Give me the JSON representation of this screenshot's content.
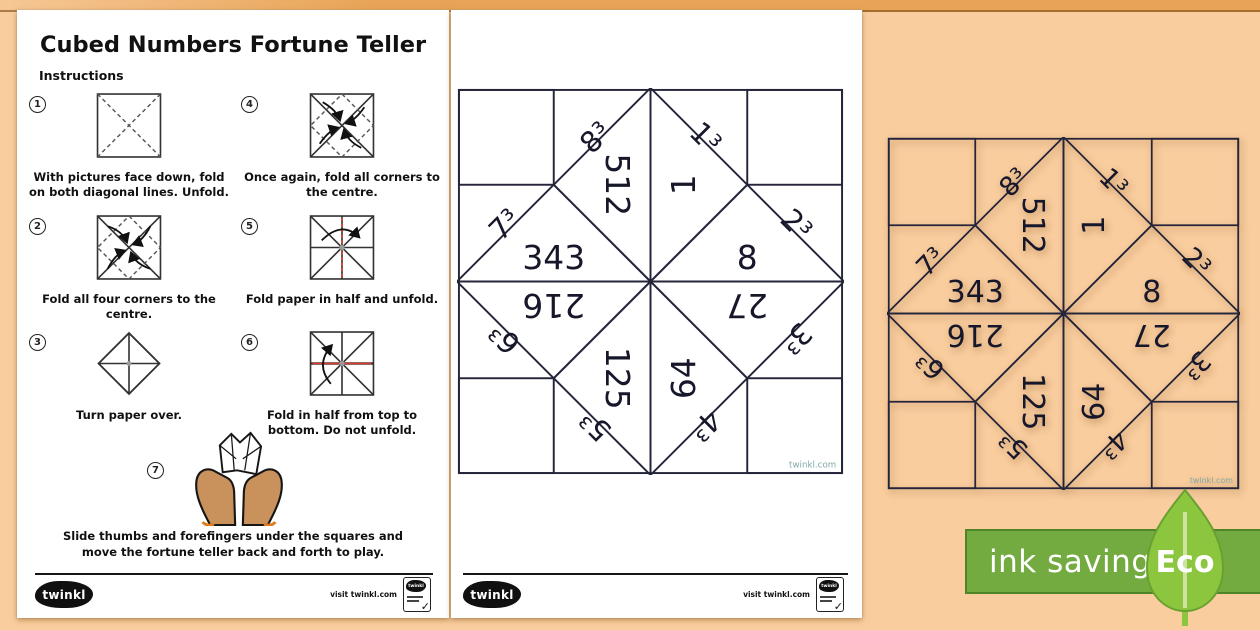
{
  "page1": {
    "title": "Cubed Numbers Fortune Teller",
    "subtitle": "Instructions",
    "steps": [
      {
        "num": "1",
        "text": "With pictures face down, fold on both diagonal lines. Unfold."
      },
      {
        "num": "2",
        "text": "Fold all four corners to the centre."
      },
      {
        "num": "3",
        "text": "Turn paper over."
      },
      {
        "num": "4",
        "text": "Once again, fold all corners to the centre."
      },
      {
        "num": "5",
        "text": "Fold paper in half and unfold."
      },
      {
        "num": "6",
        "text": "Fold in half from top to bottom. Do not unfold."
      },
      {
        "num": "7",
        "text": "Slide thumbs and forefingers under the squares and move the fortune teller back and forth to play."
      }
    ]
  },
  "teller": {
    "cubes": {
      "c1": "1³",
      "c2": "2³",
      "c3": "3³",
      "c4": "4³",
      "c5": "5³",
      "c6": "6³",
      "c7": "7³",
      "c8": "8³"
    },
    "values": {
      "v1": "1",
      "v8": "8",
      "v27": "27",
      "v64": "64",
      "v125": "125",
      "v216": "216",
      "v343": "343",
      "v512": "512"
    },
    "watermark": "twinkl.com",
    "colors": {
      "corner_green": "#c5e2c3",
      "corner_yellow": "#f8e79e",
      "corner_pink": "#f5c5c3",
      "corner_teal": "#80cbc5",
      "tri_pink": "#f5c5c3",
      "tri_yellow": "#f8e79e",
      "tri_teal": "#76c6b8",
      "tri_pale_green": "#cbe6c9",
      "line": "#24243a"
    }
  },
  "footer": {
    "brand": "twinkl",
    "visit": "visit twinkl.com",
    "badge_brand": "twinkl",
    "badge_check": "✓"
  },
  "eco": {
    "banner_label": "ink saving",
    "leaf_label": "Eco",
    "colors": {
      "banner": "#73ab41",
      "banner_border": "#4f8427",
      "leaf": "#8cc63e",
      "stem": "#cde39e"
    }
  },
  "background": {
    "canvas": "#f9cd9e",
    "top_band": "#e8a456",
    "page": "#ffffff"
  }
}
